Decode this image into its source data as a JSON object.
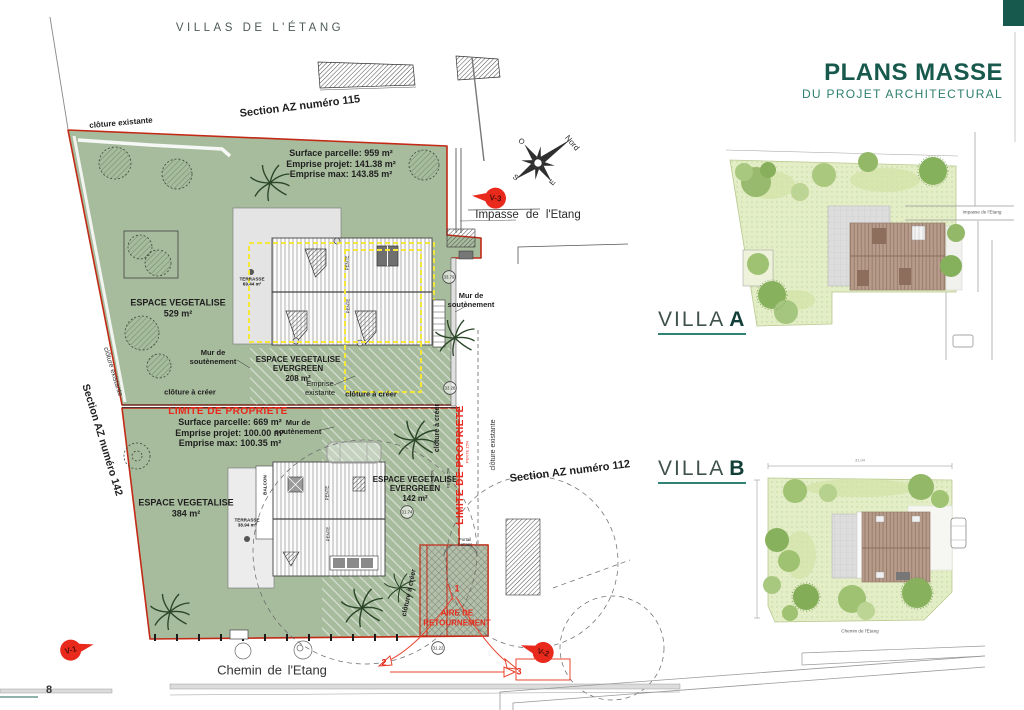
{
  "page": {
    "number": "8",
    "brand": "VILLAS DE L'ÉTANG"
  },
  "header": {
    "title": "PLANS MASSE",
    "subtitle": "DU PROJET ARCHITECTURAL"
  },
  "plan": {
    "sections": {
      "s115": "Section AZ numéro 115",
      "s142": "Section AZ numéro 142",
      "s112": "Section AZ numéro 112"
    },
    "streets": {
      "impasse": "Impasse de l'Etang",
      "chemin": "Chemin de l'Etang"
    },
    "parcel_a": {
      "surface": "Surface parcelle: 959 m²",
      "emprise_projet": "Emprise projet: 141.38 m²",
      "emprise_max": "Emprise max: 143.85 m²",
      "espace": "ESPACE VEGETALISE",
      "espace_area": "529 m²",
      "evergreen_1": "ESPACE VEGETALISE",
      "evergreen_2": "EVERGREEN",
      "evergreen_area": "208 m²",
      "terrasse": "TERRASSE",
      "terrasse_area": "69.44 m²",
      "emprise_exist_1": "Emprise",
      "emprise_exist_2": "existante"
    },
    "parcel_b": {
      "surface": "Surface parcelle: 669 m²",
      "emprise_projet": "Emprise projet: 100.00 m²",
      "emprise_max": "Emprise max: 100.35 m²",
      "espace": "ESPACE VEGETALISE",
      "espace_area": "384 m²",
      "evergreen_1": "ESPACE VEGETALISE",
      "evergreen_2": "EVERGREEN",
      "evergreen_area": "142 m²",
      "terrasse": "TERRASSE",
      "terrasse_area": "38.94 m²",
      "aire": "AIRE DE RETOURNEMENT"
    },
    "labels": {
      "limite": "LIMITE DE PROPRIETE",
      "cloture_existante": "clôture existante",
      "cloture_a_creer": "clôture à créer",
      "mur_1": "Mur de",
      "mur_2": "soutènement",
      "balcon": "BALCON",
      "pente": "PENTE",
      "pente5": "PENTE 5%",
      "pente15": "PENTE 15%",
      "portail_1": "Portail",
      "portail_2": "battant"
    },
    "compass": {
      "n": "Nord",
      "o": "O",
      "s": "S",
      "e": "E"
    },
    "markers": {
      "v1": "V-1",
      "v2": "V-2",
      "v3": "V-3",
      "n1": "1",
      "n2": "2",
      "n3": "3"
    },
    "levels": {
      "a": "33.79",
      "b": "33.28",
      "c": "31.74",
      "d": "31.22"
    }
  },
  "villa_a": {
    "name": "VILLA",
    "letter": "A",
    "street": "Impasse de l'Etang"
  },
  "villa_b": {
    "name": "VILLA",
    "letter": "B",
    "street": "Chemin de l'Etang",
    "dim_width": "31.04"
  }
}
